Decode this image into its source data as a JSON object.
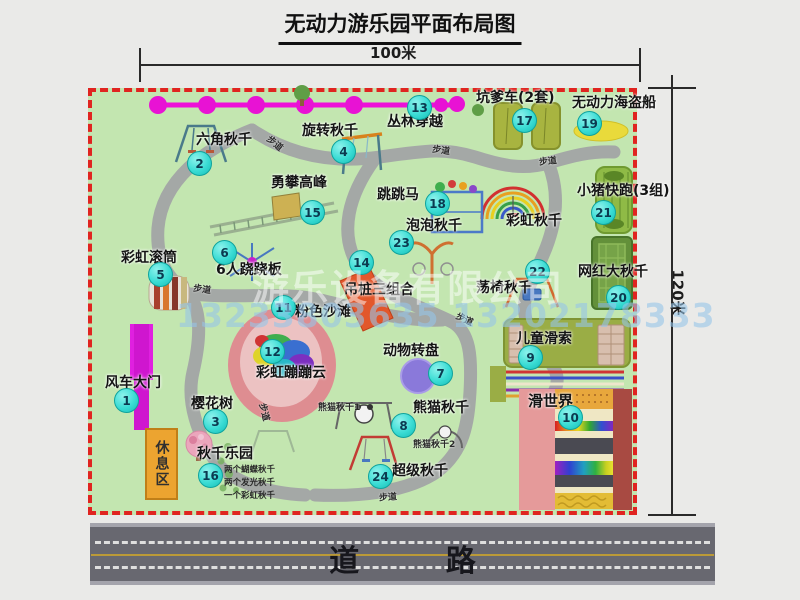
{
  "title": "无动力游乐园平面布局图",
  "dimensions": {
    "width": "100米",
    "height": "120米"
  },
  "road_label": "道 路",
  "labels": {
    "footpath": "步道",
    "rest_area": "休息区",
    "rainbow_swing": "彩虹秋千"
  },
  "watermark": {
    "company": "游乐设备有限公司",
    "phone": "13233803635 13202178333"
  },
  "attractions": [
    {
      "num": "1",
      "name": "风车大门"
    },
    {
      "num": "2",
      "name": "六角秋千"
    },
    {
      "num": "3",
      "name": "樱花树"
    },
    {
      "num": "4",
      "name": "旋转秋千"
    },
    {
      "num": "5",
      "name": "彩虹滚筒"
    },
    {
      "num": "6",
      "name": "6人跷跷板"
    },
    {
      "num": "7",
      "name": "动物转盘"
    },
    {
      "num": "8",
      "name": "熊猫秋千"
    },
    {
      "num": "9",
      "name": "儿童滑索"
    },
    {
      "num": "10",
      "name": "滑世界"
    },
    {
      "num": "11",
      "name": "粉色沙滩"
    },
    {
      "num": "12",
      "name": "彩虹蹦蹦云"
    },
    {
      "num": "13",
      "name": "丛林穿越"
    },
    {
      "num": "14",
      "name": "吊桩三组合"
    },
    {
      "num": "15",
      "name": "勇攀高峰"
    },
    {
      "num": "16",
      "name": "秋千乐园"
    },
    {
      "num": "17",
      "name": "坑爹车(2套)"
    },
    {
      "num": "18",
      "name": "跳跳马"
    },
    {
      "num": "19",
      "name": "无动力海盗船"
    },
    {
      "num": "20",
      "name": "网红大秋千"
    },
    {
      "num": "21",
      "name": "小猪快跑(3组)"
    },
    {
      "num": "22",
      "name": "荡椅秋千"
    },
    {
      "num": "23",
      "name": "泡泡秋千"
    },
    {
      "num": "24",
      "name": "超级秋千"
    }
  ],
  "swing_park_details": [
    "两个蝴蝶秋千",
    "两个发光秋千",
    "一个彩虹秋千"
  ],
  "panda_swing_sub": [
    "熊猫秋千1",
    "熊猫秋千2"
  ],
  "colors": {
    "map_green": "#c3e6b0",
    "border_red": "#e02420",
    "badge_cyan": "#3adcd4",
    "zipline_magenta": "#ee10d8",
    "gate_magenta": "#d818d8",
    "road_gray": "#686870"
  }
}
